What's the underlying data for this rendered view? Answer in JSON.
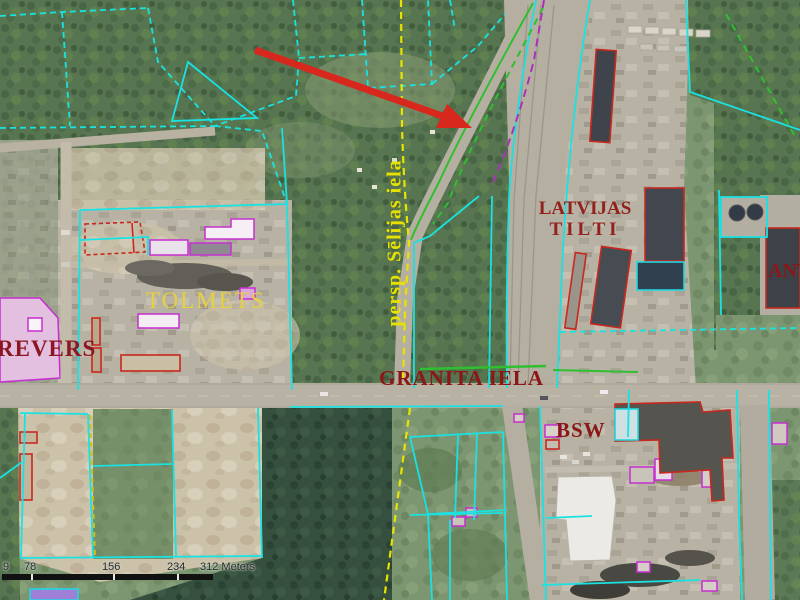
{
  "map": {
    "labels": {
      "revers": "REVERS",
      "tolmets": "TOLMETS",
      "latvijas_line1": "LATVIJAS",
      "latvijas_line2": "TILTI",
      "granita_iela": "GRANITA IELA",
      "bsw": "BSW",
      "ant": "ANT",
      "persp_street": "persp. Sēlijas iela"
    },
    "scalebar": {
      "ticks": [
        "9",
        "78",
        "156",
        "234"
      ],
      "end_label": "312 Meters"
    },
    "colors": {
      "parcel_line_cyan": "#1ae2e2",
      "building_outline_magenta": "#c62fd0",
      "building_outline_red": "#c8281e",
      "street_label_yellow": "#e8e000",
      "company_label_dark_red": "#8c1717",
      "planned_street_line_yellow": "#e8e400",
      "greenery_line_green": "#2fbf2f",
      "annotation_arrow_red": "#d8281e"
    }
  }
}
